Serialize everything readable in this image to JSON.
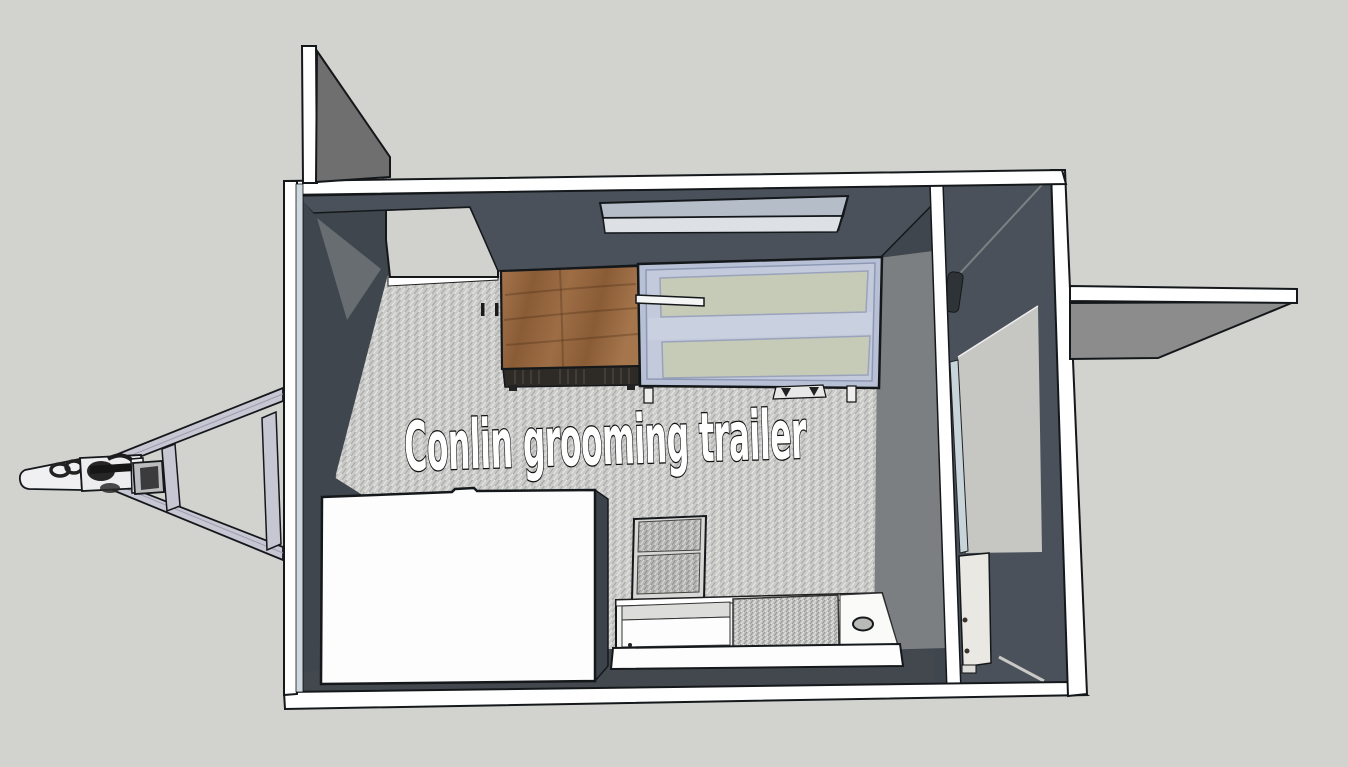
{
  "viewport": {
    "floor_label": "Conlin grooming trailer"
  },
  "colors": {
    "background": "#d2d2ce",
    "frame_white": "#ffffff",
    "outline": "#15181b",
    "wall_dark": "#4a515a",
    "wall_darker": "#3f464d",
    "wall_corner": "#6c7176",
    "wall_medium": "#7b7f82",
    "flap_gray": "#6f6f6f",
    "awning_underside": "#8c8c8c",
    "floor_base": "#cbcbc9",
    "floor_dark": "#a9a9a7",
    "floor_light": "#e6e6e4",
    "ramp_light": "#d1d1cd",
    "ramp_right": "#c6c6c3",
    "skylight_top": "#b5bdc9",
    "skylight_front": "#dde1e5",
    "tub_frame": "#b7c0d4",
    "tub_inner": "#c3cadb",
    "tub_panel": "#c6cbb7",
    "tub_panel_edge": "#9aa3bb",
    "wood_light": "#a5754c",
    "wood_dark": "#8a5c36",
    "cabinet_base": "#2e2a26",
    "mesh_base": "#b6b6b4",
    "mesh_line": "#8e8e8c",
    "surface_white": "#fdfdfd",
    "box_side": "#3d434a",
    "door_panel": "#eae8e2",
    "blue_strip": "#c7d4da",
    "left_trim_blue": "#cdd9de",
    "hitch_metal": "#c7c7d3",
    "hitch_dark": "#222222",
    "counter_band": "#dcdcda",
    "highlight_line": "#7c8184",
    "text_fill": "#ffffff",
    "text_outline": "#111111"
  }
}
